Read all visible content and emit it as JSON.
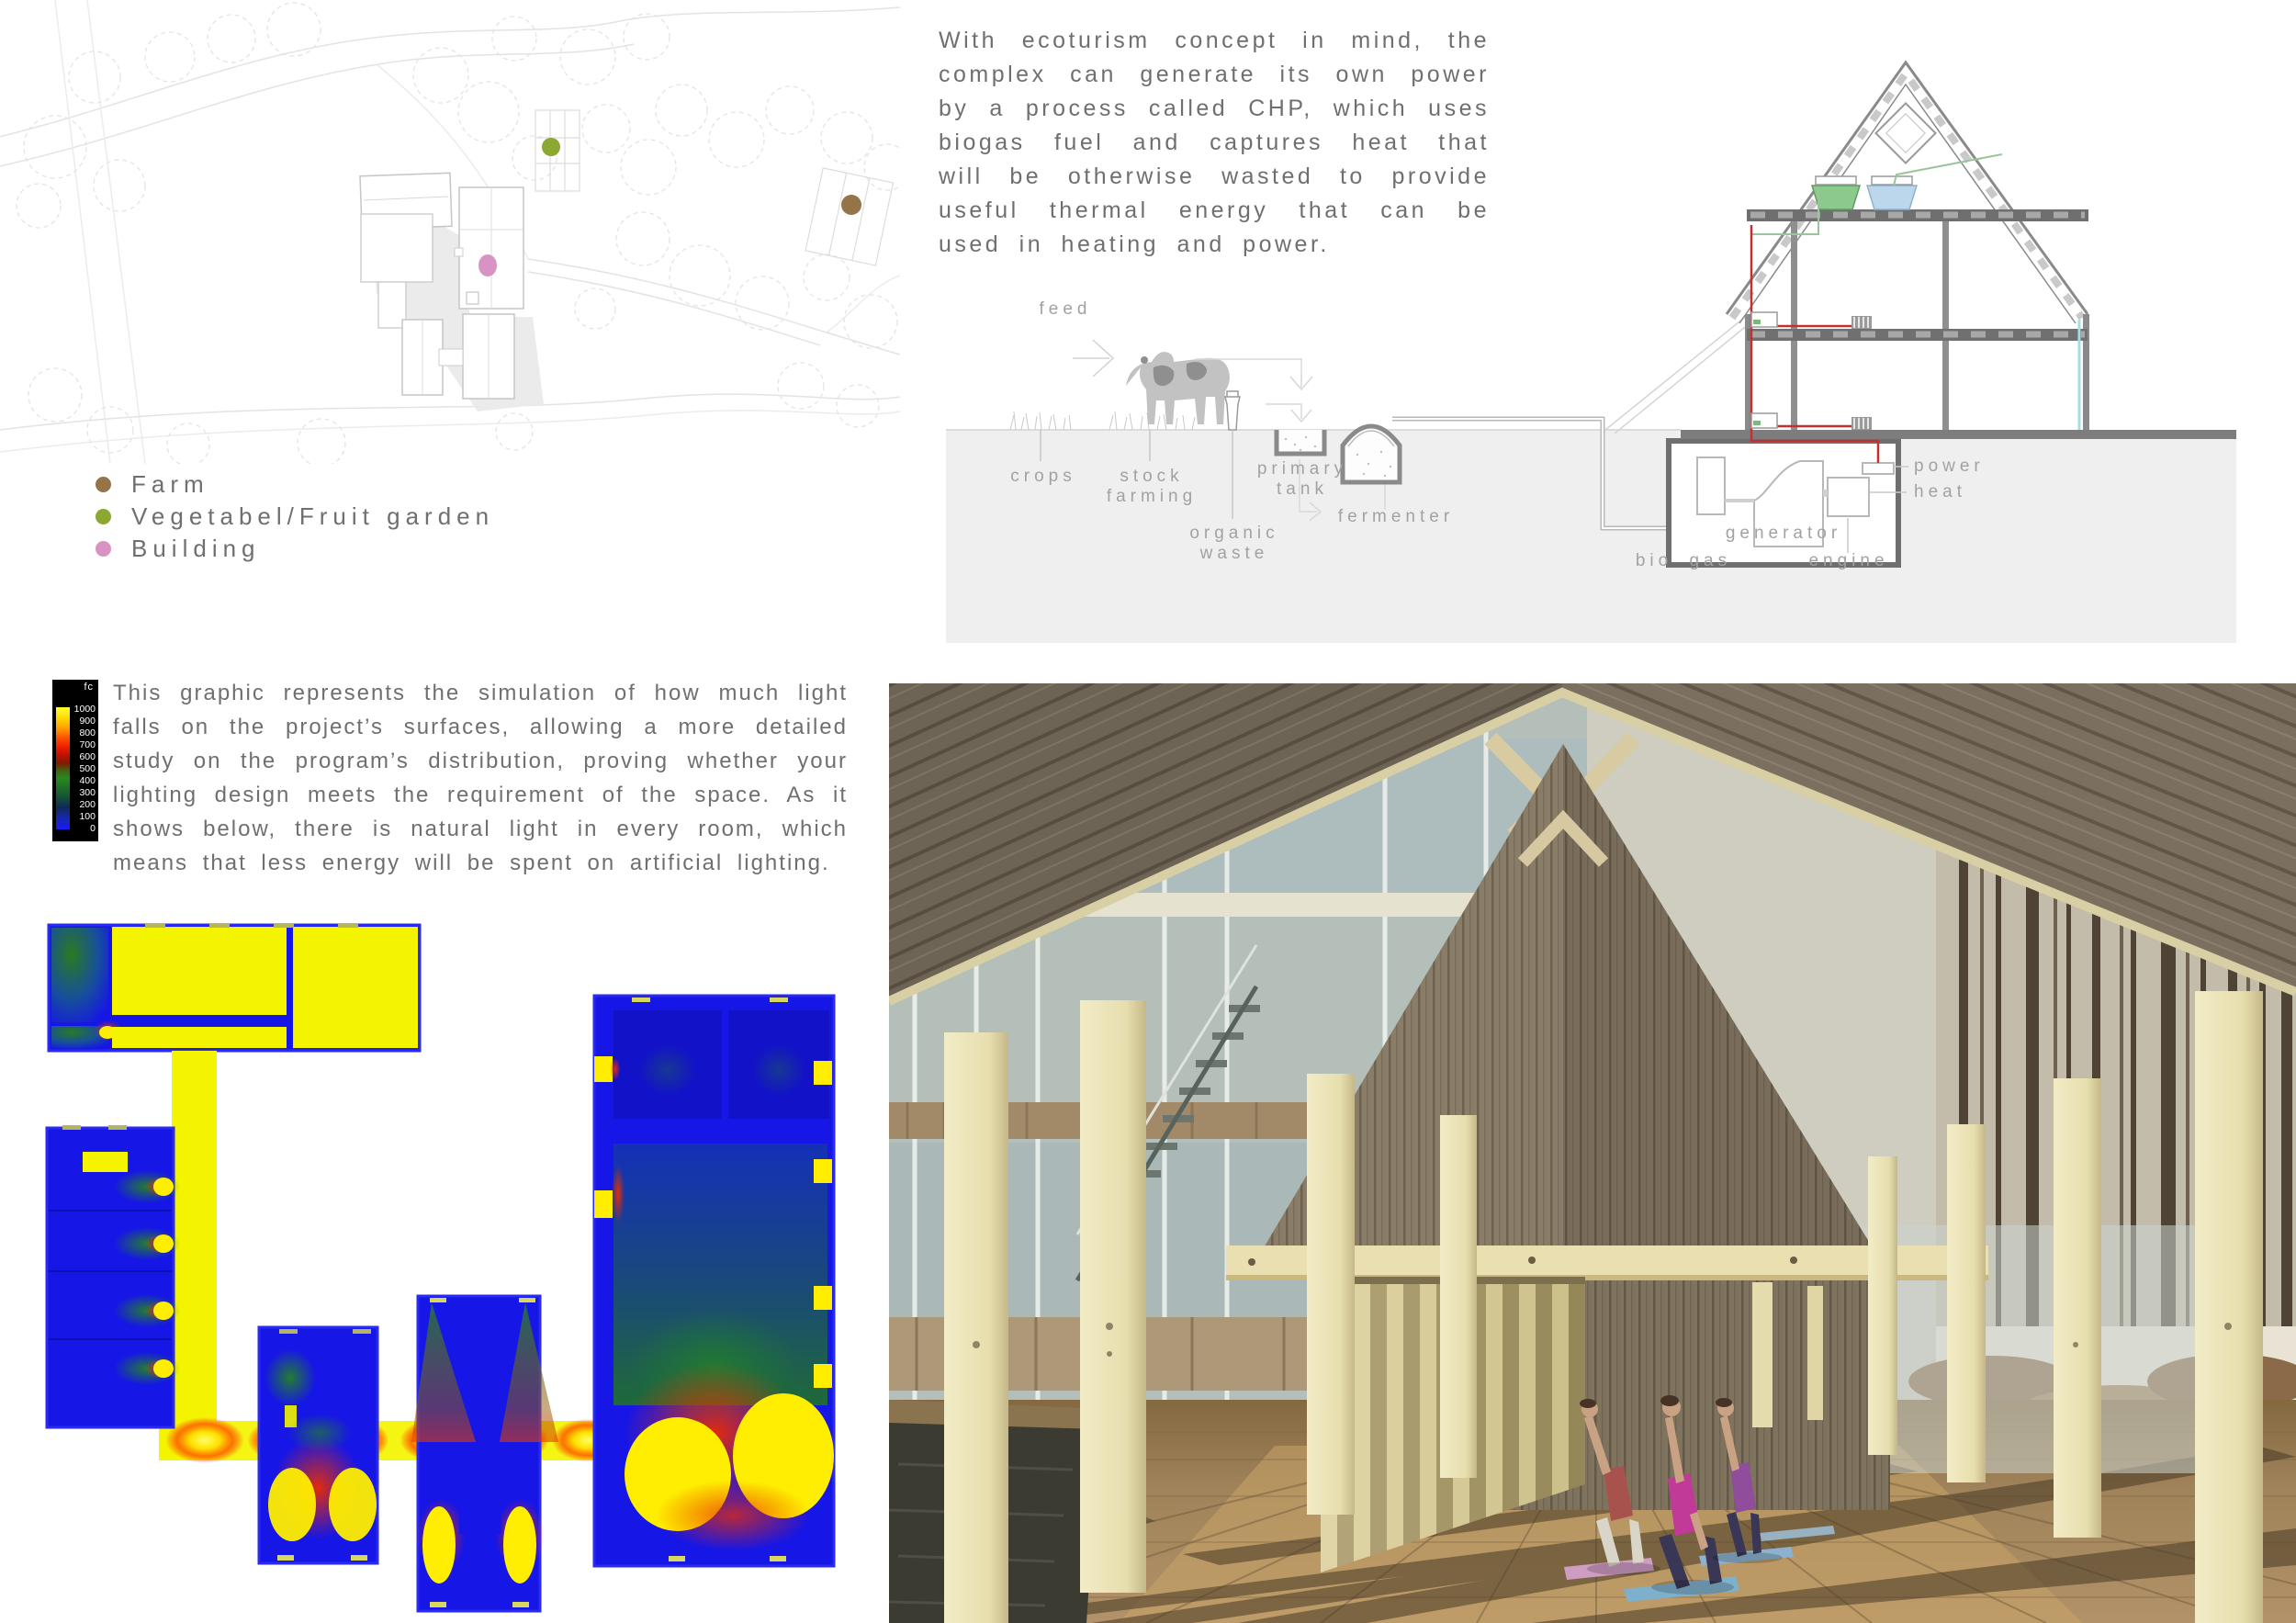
{
  "site_plan": {
    "markers": [
      {
        "name": "farm-marker",
        "color": "#96744a"
      },
      {
        "name": "garden-marker",
        "color": "#8ca832"
      },
      {
        "name": "building-marker",
        "color": "#d893c2"
      }
    ]
  },
  "legend": {
    "items": [
      {
        "label": "Farm",
        "color": "#96744a"
      },
      {
        "label": "Vegetabel/Fruit garden",
        "color": "#8ca832"
      },
      {
        "label": "Building",
        "color": "#d893c2"
      }
    ]
  },
  "intro_text": "With ecoturism concept in mind, the complex can generate its own power by a process called CHP, which uses biogas fuel and captures heat that will be otherwise wasted to provide useful thermal energy that can be used in heating and power.",
  "chp_diagram": {
    "labels": {
      "feed": "feed",
      "crops": "crops",
      "stock_farming": "stock farming",
      "organic_waste": "organic waste",
      "primary_tank": "primary tank",
      "fermenter": "fermenter",
      "bio_gas": "bio gas",
      "generator": "generator",
      "engine": "engine",
      "power": "power",
      "heat": "heat"
    },
    "accent_colors": {
      "pipe_red": "#c43030",
      "pipe_cyan": "#a5dede",
      "tank_green": "#8cc98c",
      "tank_blue": "#bcd7ec"
    }
  },
  "lighting": {
    "description": "This graphic represents the simulation of how much light falls on the project’s surfaces, allowing a more detailed study on the program’s distribution, proving whether your lighting design meets the requirement of the space. As it shows below, there is natural light in every room, which means that less energy will be spent on artificial lighting.",
    "scale": {
      "unit": "fc",
      "ticks": [
        "1000",
        "900",
        "800",
        "700",
        "600",
        "500",
        "400",
        "300",
        "200",
        "100",
        "0"
      ],
      "gradient": [
        "#ffff30",
        "#ffd800 9%",
        "#ffa000 17%",
        "#ff5000 25%",
        "#ee1c00 33%",
        "#b81000 40%",
        "#7c1c00 46%",
        "#3f6410 52%",
        "#2a8a20 58%",
        "#1e6f24 66%",
        "#14503a 74%",
        "#0e2a58 82%",
        "#1628b0 91%",
        "#1a1af8 100%"
      ],
      "heat_colors": {
        "max": "#f4f400",
        "hot": "#e83000",
        "mid": "#1d7a22",
        "min": "#1616e6"
      }
    }
  }
}
